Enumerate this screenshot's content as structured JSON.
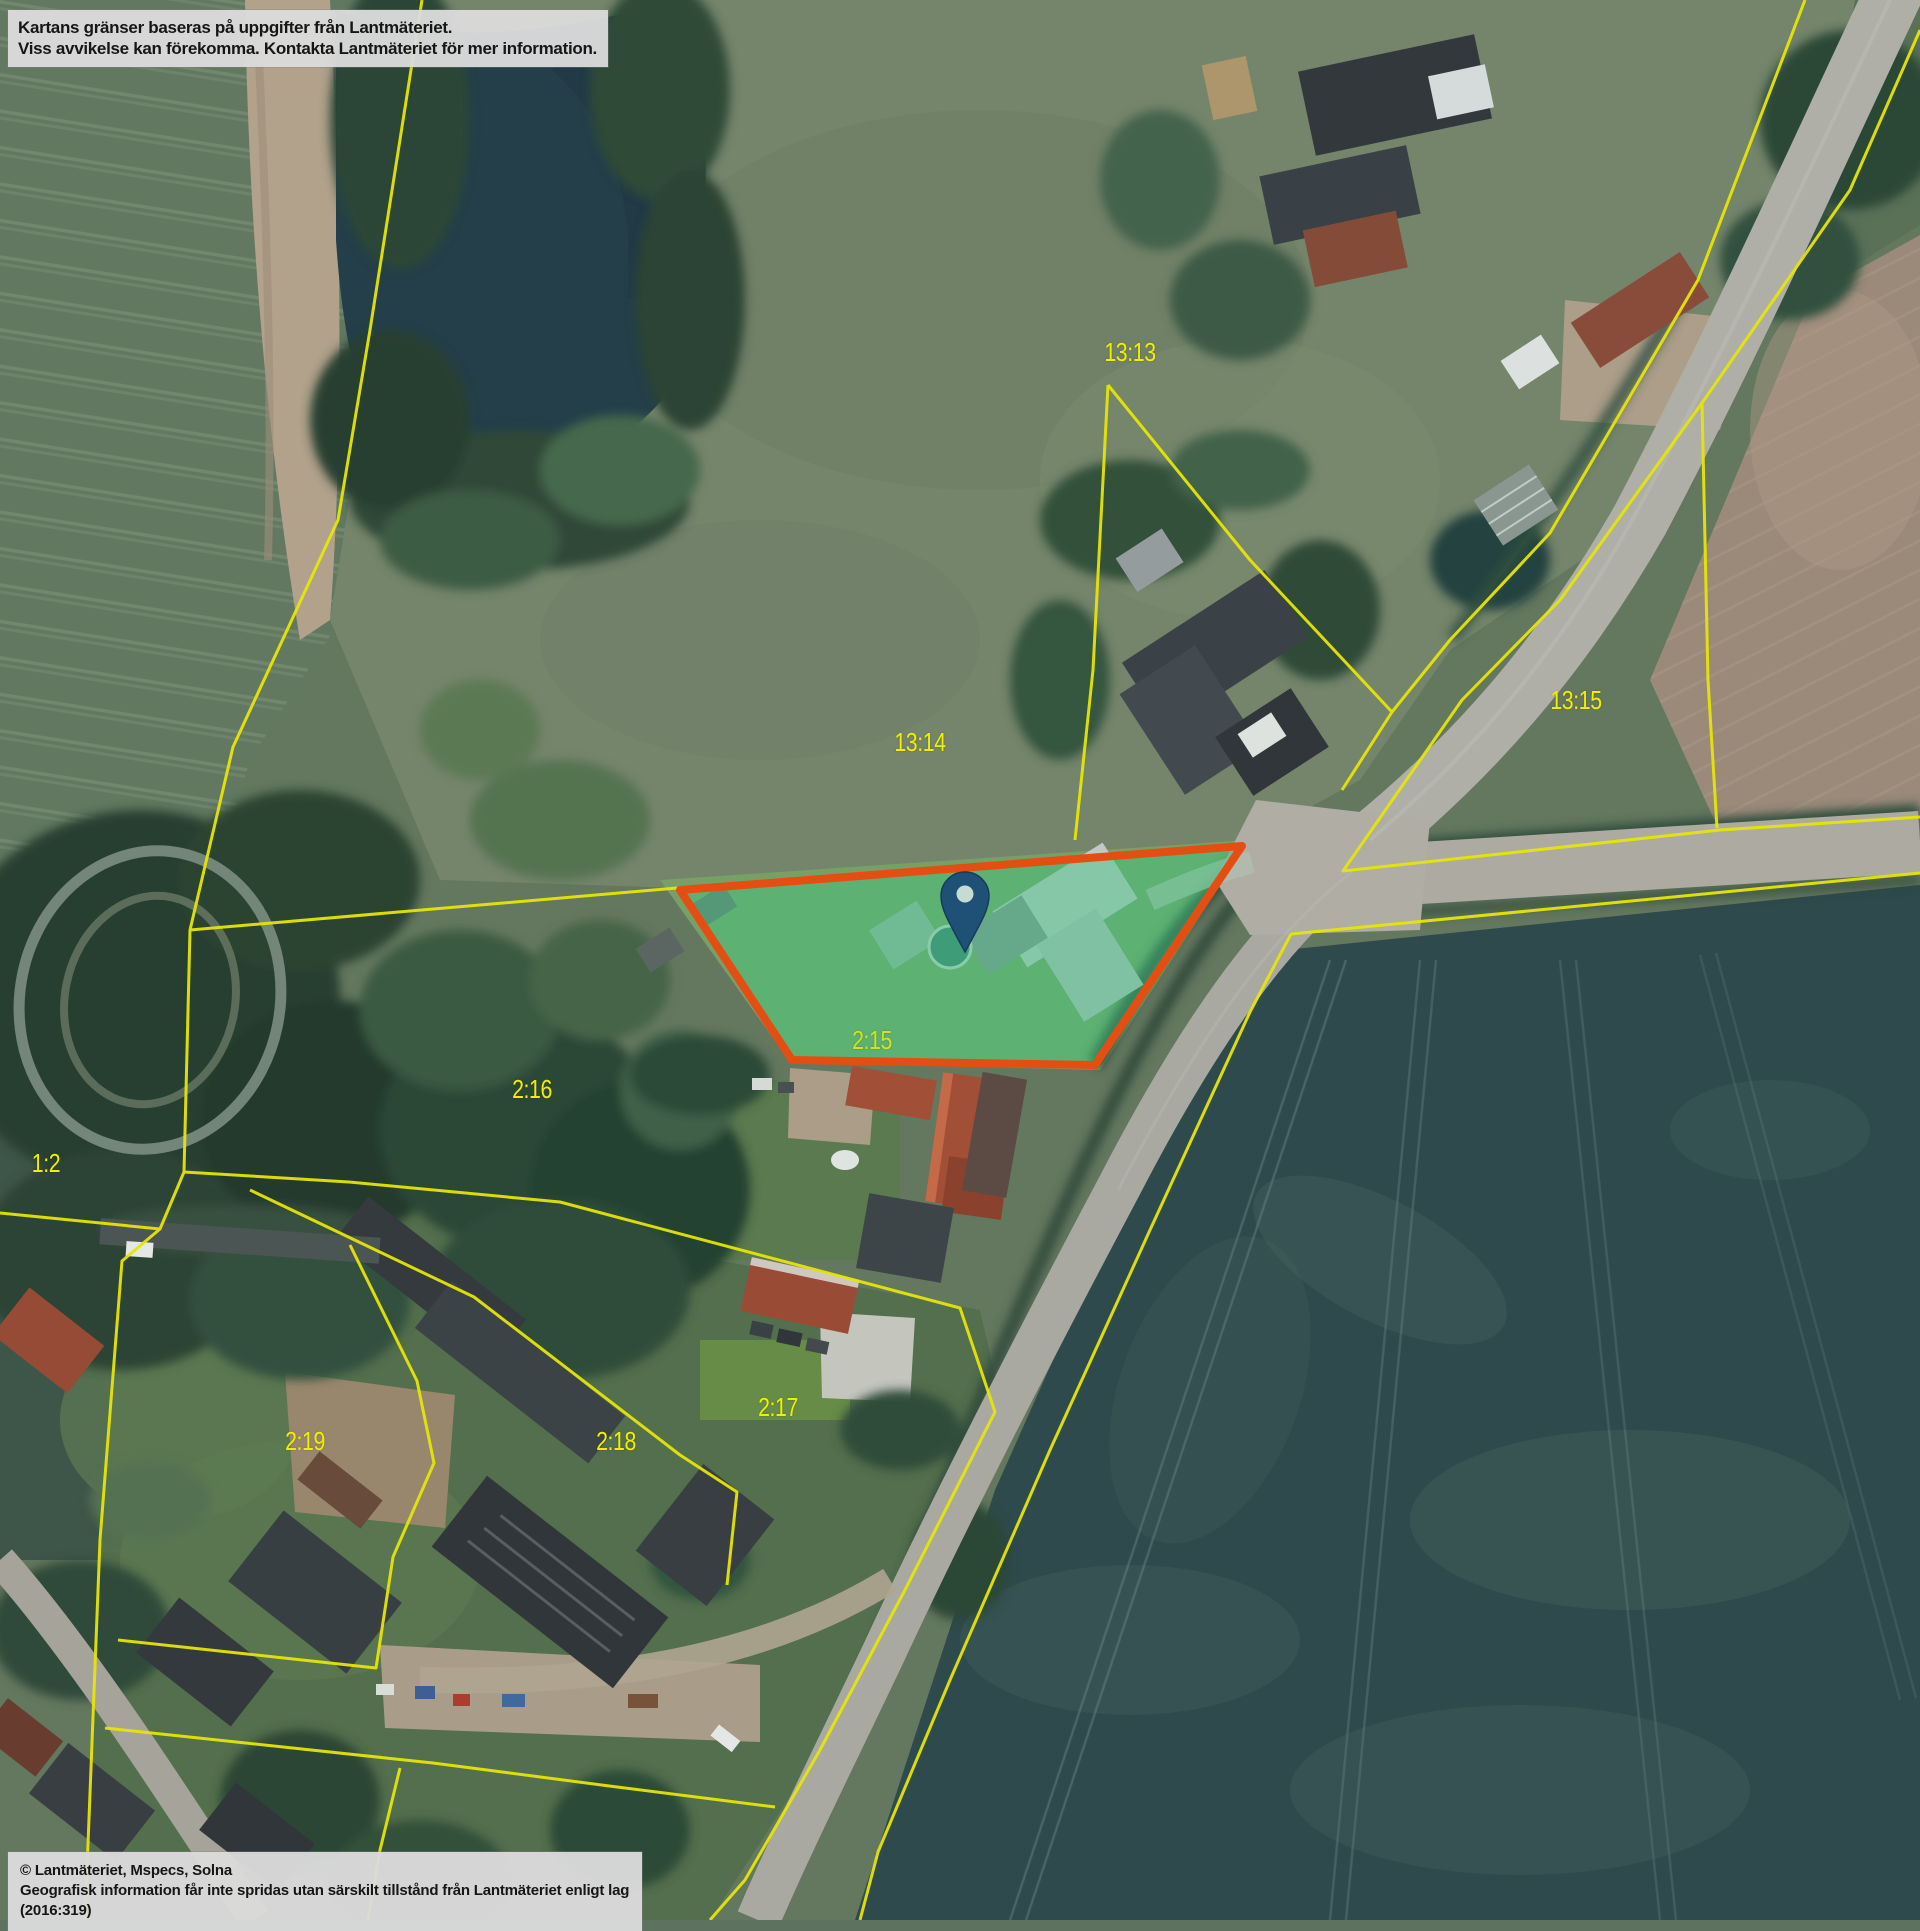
{
  "app": {
    "type": "cadastral-aerial-map",
    "basemap": "aerial-photo"
  },
  "overlays": {
    "disclaimer": {
      "line1": "Kartans gränser baseras på uppgifter från Lantmäteriet.",
      "line2": "Viss avvikelse kan förekomma. Kontakta Lantmäteriet för mer information."
    },
    "attribution": {
      "line1": "© Lantmäteriet, Mspecs, Solna",
      "line2": "Geografisk information får inte spridas utan särskilt tillstånd från Lantmäteriet enligt lag (2016:319)"
    }
  },
  "map": {
    "boundary_color": "#f0ee00",
    "label_color": "#f2ee00",
    "parcel_labels": [
      {
        "id": "13:13",
        "x": 1130,
        "y": 352
      },
      {
        "id": "13:14",
        "x": 920,
        "y": 742
      },
      {
        "id": "13:15",
        "x": 1576,
        "y": 700
      },
      {
        "id": "2:15",
        "x": 872,
        "y": 1040,
        "highlighted": true
      },
      {
        "id": "2:16",
        "x": 532,
        "y": 1089
      },
      {
        "id": "1:2",
        "x": 46,
        "y": 1163
      },
      {
        "id": "2:19",
        "x": 305,
        "y": 1441
      },
      {
        "id": "2:18",
        "x": 616,
        "y": 1441
      },
      {
        "id": "2:17",
        "x": 778,
        "y": 1407
      }
    ],
    "highlighted_parcel": {
      "id": "2:15",
      "outline_color": "#ee4d0d",
      "fill_color": "rgba(62,205,130,0.45)"
    },
    "pin": {
      "color": "#1d5078",
      "hole_color": "#cfe3d8"
    }
  }
}
